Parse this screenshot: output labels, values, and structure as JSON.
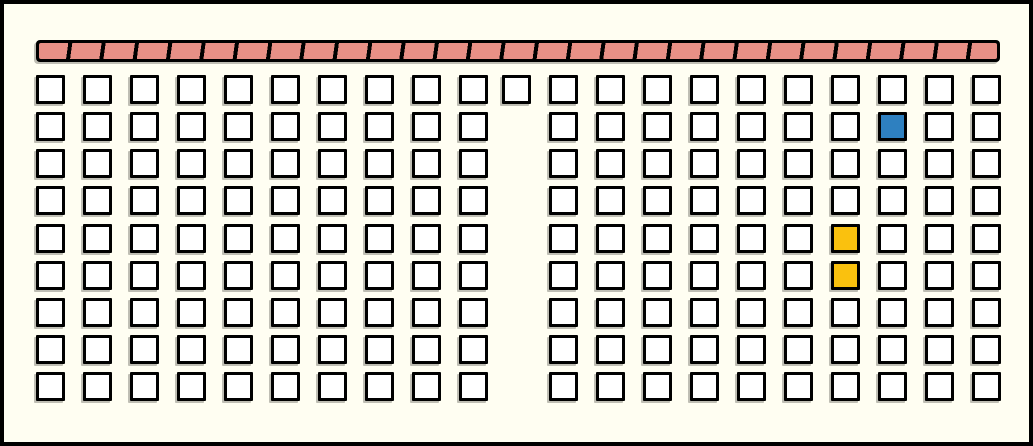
{
  "colors": {
    "background": "#FFFEF2",
    "frame_border": "#000000",
    "cell_fill": "#FFFFFF",
    "cell_border": "#000000",
    "cell_shadow": "rgba(95,95,88,0.40)",
    "bar_background": "#000000",
    "bar_stripe_fill": "#E89086",
    "highlight_blue": "#2E80C0",
    "highlight_yellow": "#FAC10E"
  },
  "front_bar": {
    "pattern": "diagonal-hatch"
  },
  "grid": {
    "rows": 9,
    "left_block_columns": 10,
    "right_block_columns": 10,
    "middle_column_rows": [
      1
    ],
    "total_cells": 181,
    "highlighted_cells": [
      {
        "row": 2,
        "block": "right",
        "column": 8,
        "color_key": "highlight_blue"
      },
      {
        "row": 5,
        "block": "right",
        "column": 7,
        "color_key": "highlight_yellow"
      },
      {
        "row": 6,
        "block": "right",
        "column": 7,
        "color_key": "highlight_yellow"
      }
    ]
  }
}
